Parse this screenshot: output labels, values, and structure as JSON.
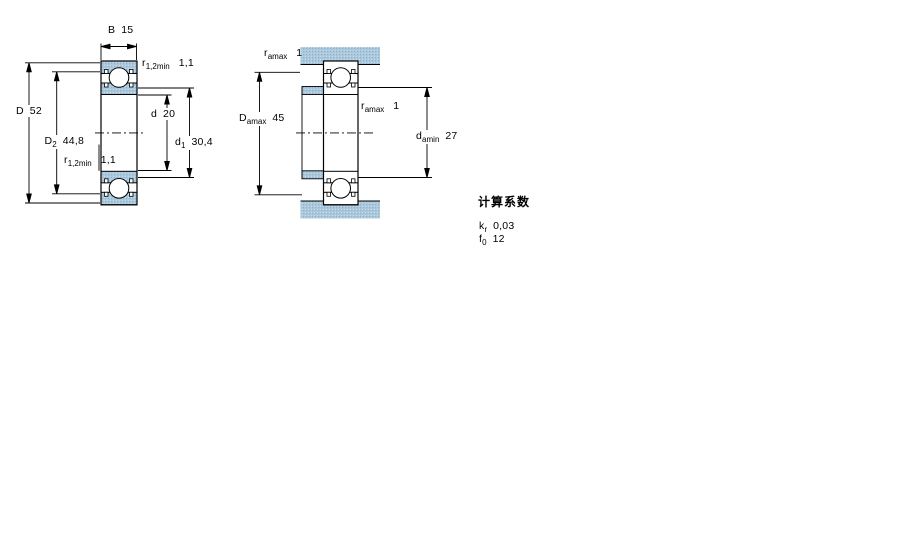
{
  "figure1": {
    "name": "bearing-section-view",
    "dim_B": {
      "sym": "B",
      "sub": "",
      "value": "15"
    },
    "dim_r_top": {
      "sym": "r",
      "sub": "1,2min",
      "value": "1,1"
    },
    "dim_D": {
      "sym": "D",
      "sub": "",
      "value": "52"
    },
    "dim_D2": {
      "sym": "D",
      "sub": "2",
      "value": "44,8"
    },
    "dim_r_bottom": {
      "sym": "r",
      "sub": "1,2min",
      "value": "1,1"
    },
    "dim_d": {
      "sym": "d",
      "sub": "",
      "value": "20"
    },
    "dim_d1": {
      "sym": "d",
      "sub": "1",
      "value": "30,4"
    }
  },
  "figure2": {
    "name": "bearing-mounted-view",
    "dim_r_top": {
      "sym": "r",
      "sub": "amax",
      "value": "1"
    },
    "dim_Damax": {
      "sym": "D",
      "sub": "amax",
      "value": "45"
    },
    "dim_r_right": {
      "sym": "r",
      "sub": "amax",
      "value": "1"
    },
    "dim_damin": {
      "sym": "d",
      "sub": "amin",
      "value": "27"
    }
  },
  "calc_factors": {
    "heading": "计算系数",
    "rows": [
      {
        "sym": "k",
        "sub": "r",
        "value": "0,03"
      },
      {
        "sym": "f",
        "sub": "0",
        "value": "12"
      }
    ]
  },
  "colors": {
    "steel_blue": "#aac7db",
    "steel_blue_dot": "#8db2cc",
    "line": "#000000"
  }
}
